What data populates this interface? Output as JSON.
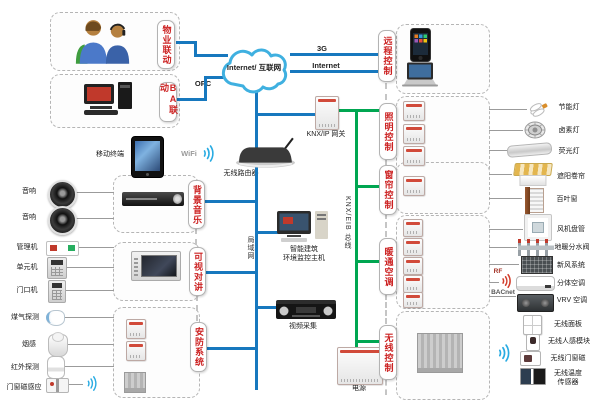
{
  "colors": {
    "lan_line": "#1778be",
    "knx_bus_line": "#00a651",
    "section_label": "#cc2222",
    "signal": "#29abe2"
  },
  "cloud": {
    "label": "Internet/ 互联网"
  },
  "net": {
    "g3": "3G",
    "internet": "Internet",
    "opc": "OPC",
    "wifi": "WiFi",
    "lan": "局域网",
    "knx_bus": "KNX/EIB 总线",
    "rf": "RF",
    "bacnet": "BACnet"
  },
  "sections": {
    "property": "物业联动",
    "ba": "BA联动",
    "bgm": "背景音乐",
    "intercom": "可视对讲",
    "security": "安防系统",
    "remote": "远程控制",
    "lighting": "照明控制",
    "curtain": "窗帘控制",
    "hvac": "暖通空调",
    "wireless": "无线控制"
  },
  "middle": {
    "mobile_terminal": "移动终端",
    "router": "无线路由器",
    "knx_ip_gateway": "KNX/IP 网关",
    "monitor_host_line1": "智能建筑",
    "monitor_host_line2": "环境监控主机",
    "video_capture": "视频采集",
    "power": "电源",
    "enocean_gateway": "KNX/EnOcean 网关"
  },
  "left": {
    "speaker1": "音响",
    "speaker2": "音响",
    "manager": "管理机",
    "unit": "单元机",
    "door": "门口机",
    "gas": "煤气探测",
    "smoke": "烟感",
    "pir": "红外探测",
    "door_magnet": "门窗磁感应",
    "bgm_host": "背景音乐主机",
    "intercom_host": "可视对讲室内主机",
    "io_module_line1": "开关量",
    "io_module_line2": "输入模块",
    "wireless_gateway": "无线网关"
  },
  "right": {
    "mobile_phone": "移动电话",
    "office_pc_line1": "办公、移动",
    "office_pc_line2": "电脑",
    "switch_driver1": "开关驱动器",
    "dimmer_driver": "通用调光驱动器",
    "fl_dimmer_line1": "荧光灯调光",
    "fl_dimmer_line2": "驱动器",
    "cfl": "节能灯",
    "halogen": "卤素灯",
    "fluorescent": "荧光灯",
    "curtain_driver": "窗帘驱动器",
    "roller": "遮阳卷帘",
    "blinds": "百叶窗",
    "fancoil_ctrl": "风机盘管控制器",
    "valve_driver": "电热阀驱动器",
    "switch_driver2": "开关驱动器",
    "ir_module": "红外发射模块",
    "ac_gateway": "空调网关",
    "fancoil": "风机盘管",
    "manifold": "地暖分水阀",
    "fresh_air": "新风系统",
    "split_ac": "分体空调",
    "vrv": "VRV 空调",
    "w_panel": "无线面板",
    "w_pir": "无线人感模块",
    "w_magnet": "无线门窗磁",
    "w_temp_line1": "无线温度",
    "w_temp_line2": "传感器"
  }
}
